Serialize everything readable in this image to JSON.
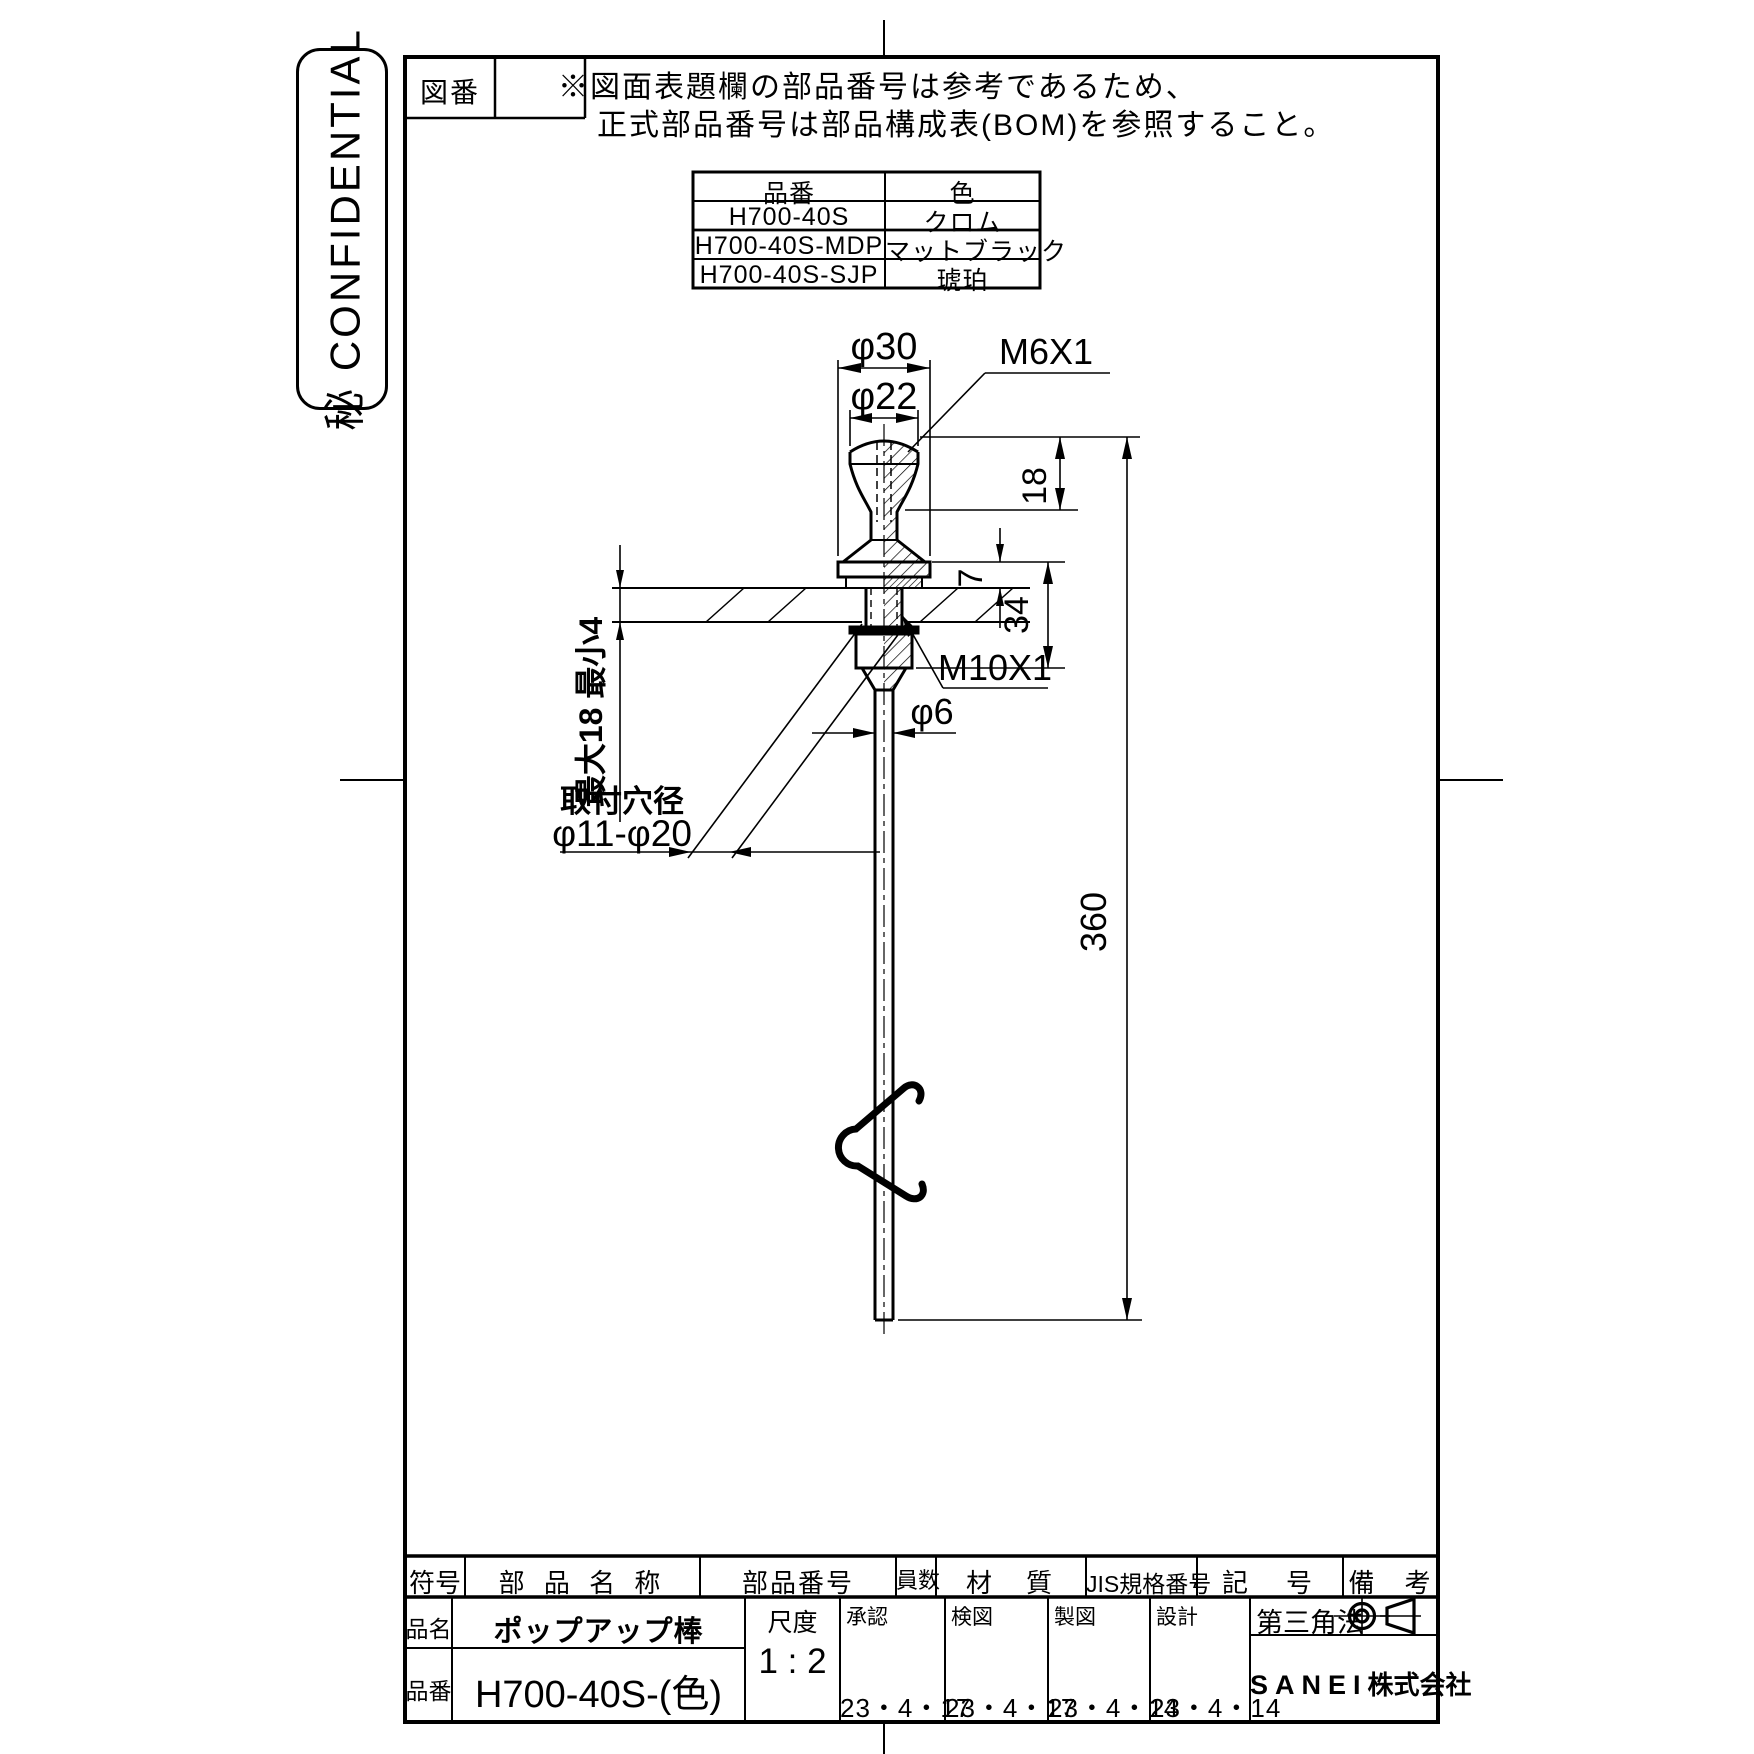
{
  "confidential": {
    "label": "秘 CONFIDENTIAL"
  },
  "drawing_no": {
    "label": "図番"
  },
  "note": {
    "line1": "※図面表題欄の部品番号は参考であるため、",
    "line2": "正式部品番号は部品構成表(BOM)を参照すること。"
  },
  "color_table": {
    "headers": [
      "品番",
      "色"
    ],
    "rows": [
      [
        "H700-40S",
        "クロム"
      ],
      [
        "H700-40S-MDP",
        "マットブラック"
      ],
      [
        "H700-40S-SJP",
        "琥珀"
      ]
    ]
  },
  "dimensions": {
    "dia30": "φ30",
    "dia22": "φ22",
    "thread_top": "M6X1",
    "h18": "18",
    "h7": "7",
    "h34": "34",
    "thread_nut": "M10X1",
    "dia6": "φ6",
    "len360": "360",
    "panel_range": "最大18 最小4",
    "hole_title": "取付穴径",
    "hole_range": "φ11-φ20"
  },
  "title_block": {
    "col_sign": "符号",
    "col_part_name": "部 品 名 称",
    "col_part_no": "部品番号",
    "col_qty": "員数",
    "col_material": "材　質",
    "col_jis": "JIS規格番号",
    "col_symbol": "記　号",
    "col_remarks": "備　考",
    "product_name_label": "品名",
    "product_name": "ポップアップ棒",
    "product_no_label": "品番",
    "product_no": "H700-40S-(色)",
    "scale_label": "尺度",
    "scale_value": "1 : 2",
    "approvals": [
      {
        "label": "承認",
        "date": "23・4・17"
      },
      {
        "label": "検図",
        "date": "23・4・17"
      },
      {
        "label": "製図",
        "date": "23・4・14"
      },
      {
        "label": "設計",
        "date": "23・4・14"
      }
    ],
    "projection_label": "第三角法",
    "company_en": "SANEI",
    "company_jp": "株式会社"
  }
}
